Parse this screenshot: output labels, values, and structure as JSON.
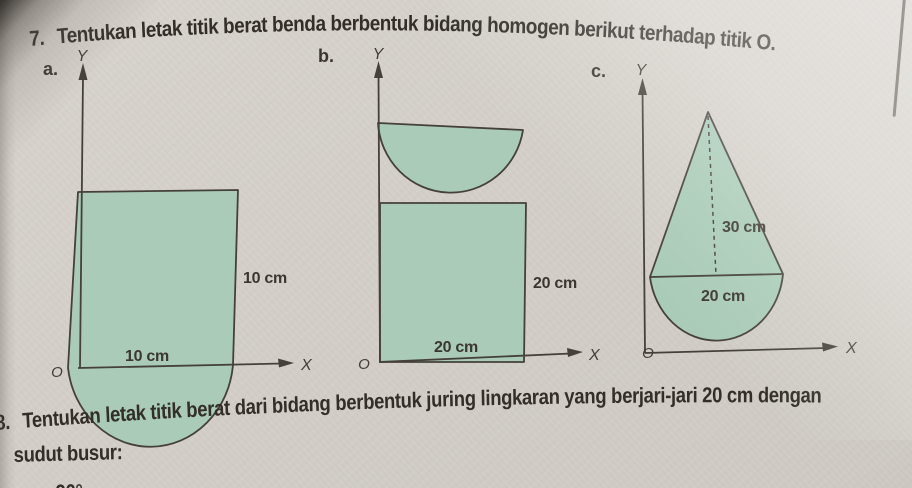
{
  "problem7": {
    "number": "7.",
    "text": "Tentukan letak titik berat benda berbentuk bidang homogen berikut terhadap titik O."
  },
  "figures": {
    "a": {
      "label": "a.",
      "y_label": "Y",
      "x_label": "X",
      "origin_label": "O",
      "side_dim": "10 cm",
      "bottom_dim": "10 cm",
      "shape": "square-with-semicircle-cutout-at-bottom"
    },
    "b": {
      "label": "b.",
      "y_label": "Y",
      "x_label": "X",
      "origin_label": "O",
      "side_dim": "20 cm",
      "bottom_dim": "20 cm",
      "shape": "square-with-downward-semicircle-on-top"
    },
    "c": {
      "label": "c.",
      "y_label": "Y",
      "x_label": "X",
      "origin_label": "O",
      "height_dim": "30 cm",
      "base_dim": "20 cm",
      "shape": "triangle-on-semicircle"
    }
  },
  "problem8": {
    "number": "8.",
    "line1": "Tentukan letak titik berat dari bidang berbentuk juring lingkaran yang berjari-jari 20 cm dengan",
    "line2": "sudut busur:",
    "item_a_label": "a.",
    "item_a_value": "90°"
  },
  "colors": {
    "paper": "#d3cfc8",
    "ink": "#45403a",
    "shape_fill": "#a9cbb7"
  }
}
